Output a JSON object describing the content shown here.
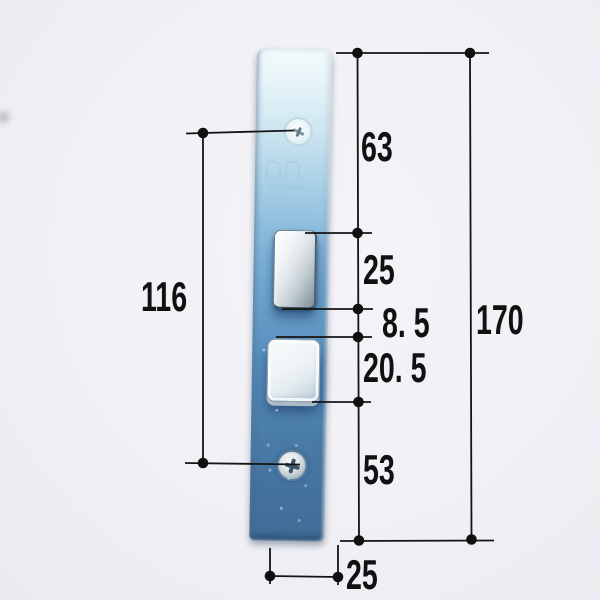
{
  "measurements": {
    "right_segments": [
      {
        "label": "63"
      },
      {
        "label": "25"
      },
      {
        "label": "8. 5"
      },
      {
        "label": "20. 5"
      },
      {
        "label": "53"
      }
    ],
    "overall_length_label": "170",
    "hole_spacing_label": "116",
    "plate_width_label": "25"
  },
  "colors": {
    "background": "#efeff4",
    "dimension_line": "#141414",
    "plate_blue_top": "#eef8fb",
    "plate_blue_mid": "#70a7d0",
    "plate_blue_bottom": "#416d98",
    "latch_chrome": "#dee4e8",
    "screw_silver": "#c3cdd3"
  }
}
